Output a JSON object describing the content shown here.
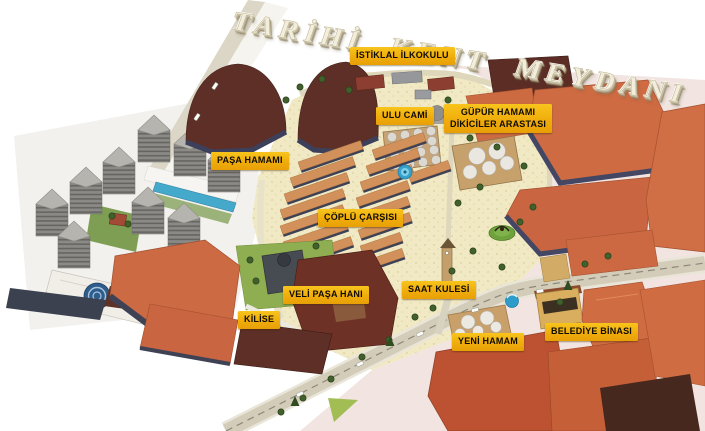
{
  "title": "TARİHİ KENT MEYDANI",
  "map_labels": {
    "istiklal_ilkokulu": "İSTİKLAL İLKOKULU",
    "ulu_cami": "ULU CAMİ",
    "gupur_hamami": {
      "line1": "GÜPÜR HAMAMI",
      "line2": "DİKİCİLER ARASTASI"
    },
    "pasa_hamami": "PAŞA HAMAMI",
    "coplu_carsisi": "ÇÖPLÜ ÇARŞISI",
    "veli_pasa_hani": "VELİ PAŞA HANI",
    "kilise": "KİLİSE",
    "saat_kulesi": "SAAT KULESİ",
    "yeni_hamam": "YENİ HAMAM",
    "belediye_binasi": "BELEDİYE BİNASI"
  },
  "colors": {
    "label_background": "#F2B211",
    "label_text": "#0F0B02",
    "title_letters": "#F3EEDC",
    "terracotta_roof": "#CC6A42",
    "dark_brown_roof": "#5E2F26",
    "market_stall_roof": "#D2905A",
    "plaza_ground": "#F0E9C3",
    "pink_ground": "#F2E4E0",
    "tower_gray": "#8B8A86",
    "water_blue": "#45A9CC",
    "tree_green": "#41602B"
  }
}
